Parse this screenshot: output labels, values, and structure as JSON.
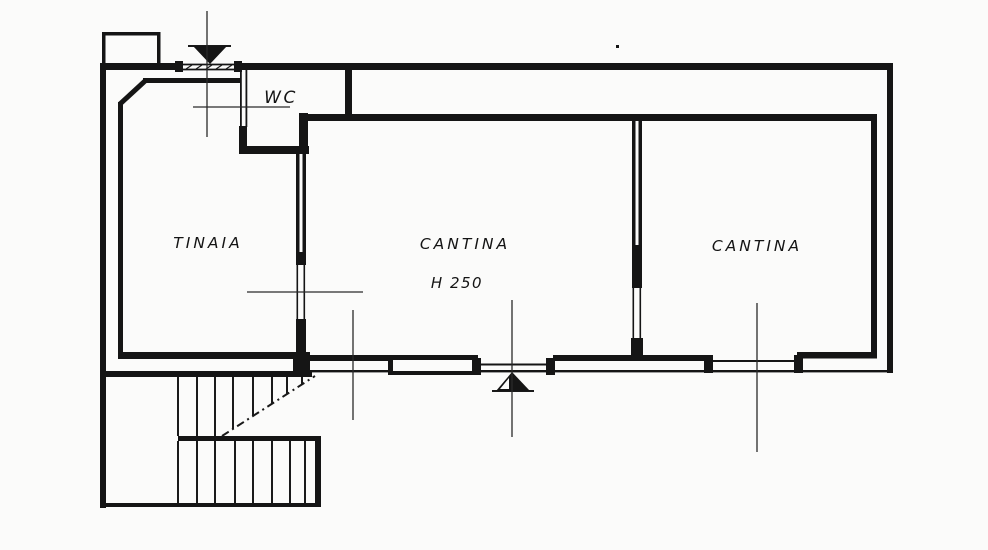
{
  "document_type": "scanned floor plan drawing",
  "colors": {
    "ink": "#151515",
    "paper": "#fbfbfa"
  },
  "rooms": [
    {
      "name": "wc",
      "label": "WC"
    },
    {
      "name": "tinaia",
      "label": "TINAIA"
    },
    {
      "name": "cantina-central",
      "label": "CANTINA",
      "ceiling_height": "H 250"
    },
    {
      "name": "cantina-right",
      "label": "CANTINA"
    }
  ],
  "markers": [
    {
      "name": "top-entrance-marker",
      "icon": "section-triangle-down-icon"
    },
    {
      "name": "bottom-entrance-marker",
      "icon": "section-triangle-up-icon"
    },
    {
      "name": "stair-break-line",
      "icon": "dashed-diagonal-line"
    }
  ]
}
